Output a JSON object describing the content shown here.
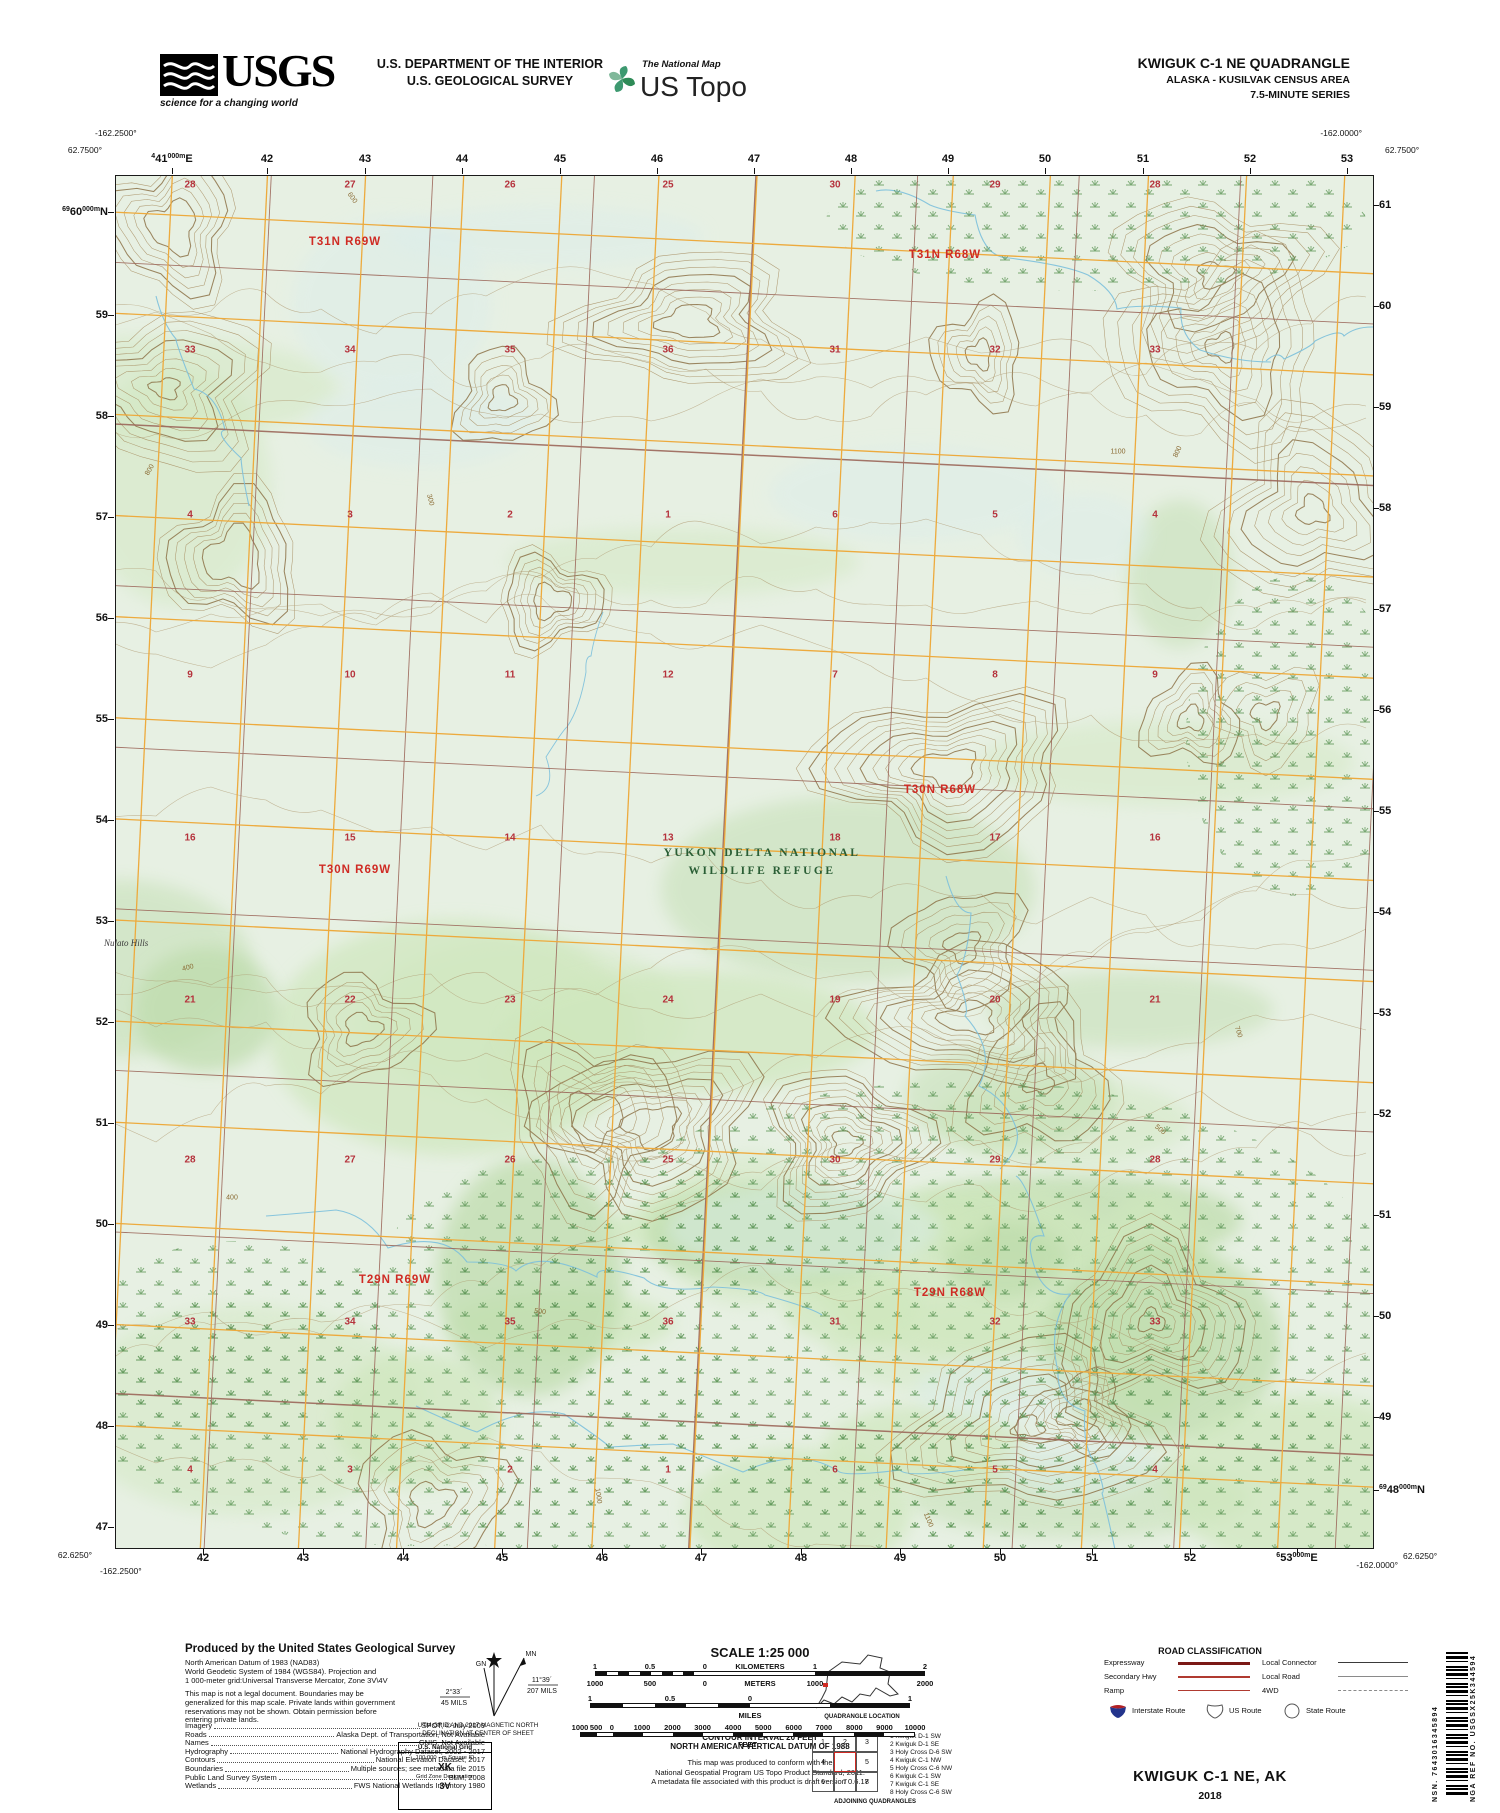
{
  "header": {
    "usgs_acronym": "USGS",
    "usgs_tagline": "science for a changing world",
    "dept_line1": "U.S. DEPARTMENT OF THE INTERIOR",
    "dept_line2": "U.S. GEOLOGICAL SURVEY",
    "tnm_label": "The National Map",
    "ustopo_label": "US Topo",
    "quad_title": "KWIGUK C-1 NE QUADRANGLE",
    "quad_sub1": "ALASKA - KUSILVAK CENSUS AREA",
    "quad_sub2": "7.5-MINUTE SERIES"
  },
  "map": {
    "palette": {
      "map_bg": "#e7f0e3",
      "veg": "#cfe7bd",
      "veg2": "#bddcab",
      "aqua": "#dcedea",
      "contour": "#a68c5f",
      "contour_index": "#8d7348",
      "grid_gold": "#edaa3d",
      "section_line": "#9c675a",
      "water": "#7cc0db",
      "marsh": "#55904f",
      "township_red": "#cf2b24",
      "section_red": "#b5323c",
      "contour_label": "#8a6a33",
      "refuge_green": "#2a5e35"
    },
    "corners": {
      "tl_lon": "-162.2500°",
      "tl_lat": "62.7500°",
      "tr_lon": "-162.0000°",
      "tr_lat": "62.7500°",
      "bl_lat": "62.6250°",
      "bl_lon": "-162.2500°",
      "br_lon": "-162.0000°",
      "br_lat": "62.6250°"
    },
    "top_labels": [
      {
        "x": 172,
        "parts": [
          "4",
          "41",
          "000m",
          "E"
        ]
      },
      {
        "x": 267,
        "t": "42"
      },
      {
        "x": 365,
        "t": "43"
      },
      {
        "x": 462,
        "t": "44"
      },
      {
        "x": 560,
        "t": "45"
      },
      {
        "x": 657,
        "t": "46"
      },
      {
        "x": 754,
        "t": "47"
      },
      {
        "x": 851,
        "t": "48"
      },
      {
        "x": 948,
        "t": "49"
      },
      {
        "x": 1045,
        "t": "50"
      },
      {
        "x": 1143,
        "t": "51"
      },
      {
        "x": 1250,
        "t": "52"
      },
      {
        "x": 1347,
        "t": "53"
      }
    ],
    "bottom_labels": [
      {
        "x": 203,
        "t": "42"
      },
      {
        "x": 303,
        "t": "43"
      },
      {
        "x": 403,
        "t": "44"
      },
      {
        "x": 502,
        "t": "45"
      },
      {
        "x": 602,
        "t": "46"
      },
      {
        "x": 701,
        "t": "47"
      },
      {
        "x": 801,
        "t": "48"
      },
      {
        "x": 900,
        "t": "49"
      },
      {
        "x": 1000,
        "t": "50"
      },
      {
        "x": 1092,
        "t": "51"
      },
      {
        "x": 1190,
        "t": "52"
      },
      {
        "x": 1297,
        "parts": [
          "6",
          "53",
          "000m",
          "E"
        ]
      }
    ],
    "left_labels": [
      {
        "y": 212,
        "parts": [
          "69",
          "60",
          "000m",
          "N"
        ]
      },
      {
        "y": 315,
        "t": "59"
      },
      {
        "y": 416,
        "t": "58"
      },
      {
        "y": 517,
        "t": "57"
      },
      {
        "y": 618,
        "t": "56"
      },
      {
        "y": 719,
        "t": "55"
      },
      {
        "y": 820,
        "t": "54"
      },
      {
        "y": 921,
        "t": "53"
      },
      {
        "y": 1022,
        "t": "52"
      },
      {
        "y": 1123,
        "t": "51"
      },
      {
        "y": 1224,
        "t": "50"
      },
      {
        "y": 1325,
        "t": "49"
      },
      {
        "y": 1426,
        "t": "48"
      },
      {
        "y": 1527,
        "t": "47"
      }
    ],
    "right_labels": [
      {
        "y": 205,
        "t": "61"
      },
      {
        "y": 306,
        "t": "60"
      },
      {
        "y": 407,
        "t": "59"
      },
      {
        "y": 508,
        "t": "58"
      },
      {
        "y": 609,
        "t": "57"
      },
      {
        "y": 710,
        "t": "56"
      },
      {
        "y": 811,
        "t": "55"
      },
      {
        "y": 912,
        "t": "54"
      },
      {
        "y": 1013,
        "t": "53"
      },
      {
        "y": 1114,
        "t": "52"
      },
      {
        "y": 1215,
        "t": "51"
      },
      {
        "y": 1316,
        "t": "50"
      },
      {
        "y": 1417,
        "t": "49"
      },
      {
        "y": 1490,
        "parts": [
          "69",
          "48",
          "000m",
          "N"
        ]
      }
    ],
    "townships": [
      {
        "t": "T31N R69W",
        "x": 345,
        "y": 242
      },
      {
        "t": "T31N R68W",
        "x": 945,
        "y": 255
      },
      {
        "t": "T30N R68W",
        "x": 940,
        "y": 790
      },
      {
        "t": "T30N R69W",
        "x": 355,
        "y": 870
      },
      {
        "t": "T29N R69W",
        "x": 395,
        "y": 1280
      },
      {
        "t": "T29N R68W",
        "x": 950,
        "y": 1293
      }
    ],
    "sections": {
      "cols": [
        190,
        350,
        510,
        668,
        835,
        995,
        1155
      ],
      "rows": [
        {
          "y": 185,
          "vals": [
            28,
            27,
            26,
            25,
            30,
            29,
            28
          ]
        },
        {
          "y": 350,
          "vals": [
            33,
            34,
            35,
            36,
            31,
            32,
            33
          ]
        },
        {
          "y": 515,
          "vals": [
            4,
            3,
            2,
            1,
            6,
            5,
            4
          ]
        },
        {
          "y": 675,
          "vals": [
            9,
            10,
            11,
            12,
            7,
            8,
            9
          ]
        },
        {
          "y": 838,
          "vals": [
            16,
            15,
            14,
            13,
            18,
            17,
            16
          ]
        },
        {
          "y": 1000,
          "vals": [
            21,
            22,
            23,
            24,
            19,
            20,
            21
          ]
        },
        {
          "y": 1160,
          "vals": [
            28,
            27,
            26,
            25,
            30,
            29,
            28
          ]
        },
        {
          "y": 1322,
          "vals": [
            33,
            34,
            35,
            36,
            31,
            32,
            33
          ]
        },
        {
          "y": 1470,
          "vals": [
            4,
            3,
            2,
            1,
            6,
            5,
            4
          ]
        }
      ]
    },
    "contour_labels": [
      {
        "t": "400",
        "x": 188,
        "y": 968,
        "r": -15
      },
      {
        "t": "500",
        "x": 540,
        "y": 1312,
        "r": 8
      },
      {
        "t": "300",
        "x": 430,
        "y": 500,
        "r": 75
      },
      {
        "t": "600",
        "x": 352,
        "y": 198,
        "r": 55
      },
      {
        "t": "700",
        "x": 1238,
        "y": 1032,
        "r": 72
      },
      {
        "t": "800",
        "x": 1178,
        "y": 452,
        "r": -65
      },
      {
        "t": "1000",
        "x": 598,
        "y": 1496,
        "r": 82
      },
      {
        "t": "1100",
        "x": 928,
        "y": 1520,
        "r": 68
      },
      {
        "t": "1100",
        "x": 1118,
        "y": 452,
        "r": 0
      },
      {
        "t": "400",
        "x": 232,
        "y": 1198,
        "r": 0
      },
      {
        "t": "500",
        "x": 1160,
        "y": 1130,
        "r": 40
      },
      {
        "t": "800",
        "x": 150,
        "y": 470,
        "r": -60
      }
    ],
    "place_labels": {
      "refuge_line1": "YUKON DELTA NATIONAL",
      "refuge_line2": "WILDLIFE REFUGE",
      "refuge_x": 762,
      "refuge_y1": 853,
      "refuge_y2": 871,
      "hills": "Nulato Hills",
      "hills_x": 104,
      "hills_y": 938
    }
  },
  "footer": {
    "produced_title": "Produced by the United States Geological Survey",
    "datum_lines": [
      "North American Datum of 1983 (NAD83)",
      "World Geodetic System of 1984 (WGS84).  Projection and",
      "1 000-meter grid:Universal Transverse Mercator, Zone 3V\\4V"
    ],
    "legal_lines": [
      "This map is not a legal document. Boundaries may be",
      "generalized for this map scale. Private lands within government",
      "reservations may not be shown. Obtain permission before",
      "entering private lands."
    ],
    "credits": [
      [
        "Imagery",
        "SPOT,  ©  July  2009"
      ],
      [
        "Roads",
        "Alaska  Dept.  of  Transportation,  Not  Available"
      ],
      [
        "Names",
        "GNIS,  Not  Available"
      ],
      [
        "Hydrography",
        "National  Hydrography  Dataset,  2002  -  2017"
      ],
      [
        "Contours",
        "National  Elevation  Dataset,  2017"
      ],
      [
        "Boundaries",
        "Multiple  sources;  see  metadata  file  2015"
      ],
      [
        "Public  Land  Survey  System",
        "BLM,  2008"
      ],
      [
        "Wetlands",
        "FWS  National  Wetlands  Inventory  1980"
      ]
    ],
    "declination": {
      "star_label": "",
      "gn_label": "GN",
      "mn_label": "MN",
      "gn_deg": "2°33´",
      "gn_mils": "45 MILS",
      "mn_deg": "11°39´",
      "mn_mils": "207 MILS",
      "caption1": "UTM GRID AND 2017 MAGNETIC NORTH",
      "caption2": "DECLINATION AT CENTER OF SHEET"
    },
    "usng": {
      "title": "U.S. National Grid",
      "sub": "100,000 - m Square ID",
      "square": "XK",
      "zone_label": "Grid Zone Designation",
      "zone": "3V"
    },
    "scale": {
      "title": "SCALE 1:25 000",
      "km_top": [
        [
          "1",
          0
        ],
        [
          "0.5",
          0.1665
        ],
        [
          "0",
          0.333
        ],
        [
          "KILOMETERS",
          0.5
        ],
        [
          "1",
          0.6665
        ],
        [
          "2",
          1
        ]
      ],
      "meters": [
        [
          "1000",
          0
        ],
        [
          "500",
          0.1665
        ],
        [
          "0",
          0.333
        ],
        [
          "METERS",
          0.5
        ],
        [
          "1000",
          0.6665
        ],
        [
          "2000",
          1
        ]
      ],
      "miles_top": [
        [
          "1",
          0
        ],
        [
          "0.5",
          0.25
        ],
        [
          "0",
          0.5
        ],
        [
          "1",
          1
        ]
      ],
      "miles_word": "MILES",
      "feet": [
        [
          "1000",
          0
        ],
        [
          "500",
          0.048
        ],
        [
          "0",
          0.095
        ],
        [
          "1000",
          0.185
        ],
        [
          "2000",
          0.276
        ],
        [
          "3000",
          0.366
        ],
        [
          "4000",
          0.457
        ],
        [
          "5000",
          0.547
        ],
        [
          "6000",
          0.638
        ],
        [
          "7000",
          0.728
        ],
        [
          "8000",
          0.819
        ],
        [
          "9000",
          0.909
        ],
        [
          "10000",
          1
        ]
      ],
      "feet_word": "FEET"
    },
    "contour_note": [
      "CONTOUR INTERVAL 20 FEET",
      "NORTH AMERICAN VERTICAL DATUM OF 1988"
    ],
    "conformance": [
      "This map was produced to conform with the",
      "National Geospatial Program US Topo Product Standard, 2011.",
      "A metadata file associated with this product is draft version 0.6.17"
    ],
    "location_caption": "QUADRANGLE LOCATION",
    "roads": {
      "title": "ROAD CLASSIFICATION",
      "left": [
        {
          "label": "Expressway",
          "color": "#7a1816",
          "h": 3,
          "dash": ""
        },
        {
          "label": "Secondary Hwy",
          "color": "#b03a30",
          "h": 2,
          "dash": ""
        },
        {
          "label": "Ramp",
          "color": "#b03a30",
          "h": 1.2,
          "dash": ""
        }
      ],
      "right": [
        {
          "label": "Local Connector",
          "color": "#3a3a3a",
          "h": 1.4,
          "dash": ""
        },
        {
          "label": "Local Road",
          "color": "#8a8a8a",
          "h": 1.1,
          "dash": ""
        },
        {
          "label": "4WD",
          "color": "#8a8a8a",
          "h": 1.1,
          "dash": "6 4"
        }
      ],
      "shields": [
        {
          "label": "Interstate Route",
          "type": "interstate"
        },
        {
          "label": "US Route",
          "type": "us"
        },
        {
          "label": "State Route",
          "type": "state"
        }
      ]
    },
    "adjoining": {
      "caption": "ADJOINING QUADRANGLES",
      "grid": [
        [
          "1",
          "2",
          "3"
        ],
        [
          "4",
          "",
          "5"
        ],
        [
          "6",
          "7",
          "8"
        ]
      ],
      "list": [
        "1  Kwiguk D-1 SW",
        "2  Kwiguk D-1 SE",
        "3  Holy Cross D-6 SW",
        "4  Kwiguk C-1 NW",
        "5  Holy Cross C-6 NW",
        "6  Kwiguk C-1 SW",
        "7  Kwiguk C-1 SE",
        "8  Holy Cross C-6 SW"
      ]
    },
    "title_block": {
      "title": "KWIGUK C-1 NE,  AK",
      "year": "2018"
    },
    "sidebar": {
      "nsn": "NSN.  7643016345894",
      "nga": "NGA REF NO.  USGSX25K344594"
    }
  }
}
